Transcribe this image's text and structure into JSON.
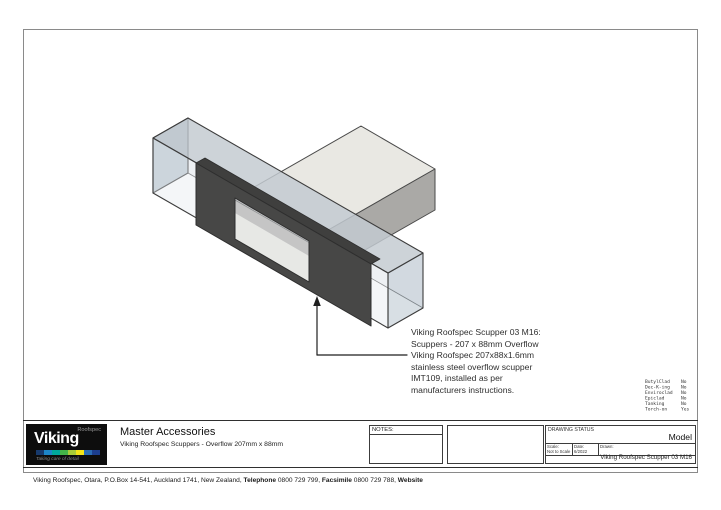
{
  "drawing": {
    "annotation": {
      "lines": [
        "Viking Roofspec Scupper 03 M16:",
        "Scuppers - 207 x 88mm Overflow",
        "Viking Roofspec 207x88x1.6mm",
        "stainless steel overflow scupper",
        "IMT109, installed as per",
        "manufacturers instructions."
      ]
    },
    "colors": {
      "plate": "#474746",
      "wall_end_face": "#9cadba",
      "wall_top_face": "#c1c9d0",
      "sleeve_top": "#e9e8e3",
      "sleeve_side": "#aaa9a6",
      "hole_interior": "#eae8e1",
      "edge": "#3c3c3c"
    }
  },
  "spec_flags": {
    "rows": [
      {
        "name": "ButylClad",
        "value": "No"
      },
      {
        "name": "Dec-K-ing",
        "value": "No"
      },
      {
        "name": "Enviroclad",
        "value": "No"
      },
      {
        "name": "Epiclad",
        "value": "No"
      },
      {
        "name": "Tanking",
        "value": "No"
      },
      {
        "name": "Torch-on",
        "value": "Yes"
      }
    ]
  },
  "title_block": {
    "logo": {
      "brand": "Viking",
      "brand_sup": "Roofspec",
      "tagline": "Taking care of detail",
      "strip_colors": [
        "#173a6d",
        "#1d86c8",
        "#00a79b",
        "#44b449",
        "#a8cc39",
        "#f2e418",
        "#2a6db5",
        "#1c3e8e"
      ]
    },
    "product_title": "Master Accessories",
    "product_subtitle": "Viking Roofspec Scuppers - Overflow 207mm x 88mm",
    "notes_label": "NOTES:",
    "drawing_status_label": "DRAWING STATUS",
    "status_value": "Model",
    "scale_label": "Scale:",
    "scale_value": "Not to Scale",
    "date_label": "Date:",
    "date_value": "6/2022",
    "drawn_label": "Drawn:",
    "doc_code": "Viking Roofspec Scupper 03 M16"
  },
  "footer": {
    "address": "Viking Roofspec, Otara, P.O.Box 14-541, Auckland 1741, New Zealand,",
    "phone_label": "Telephone",
    "phone": "0800 729 799,",
    "fax_label": "Facsimile",
    "fax": "0800 729 788,",
    "website_label": "Website"
  }
}
